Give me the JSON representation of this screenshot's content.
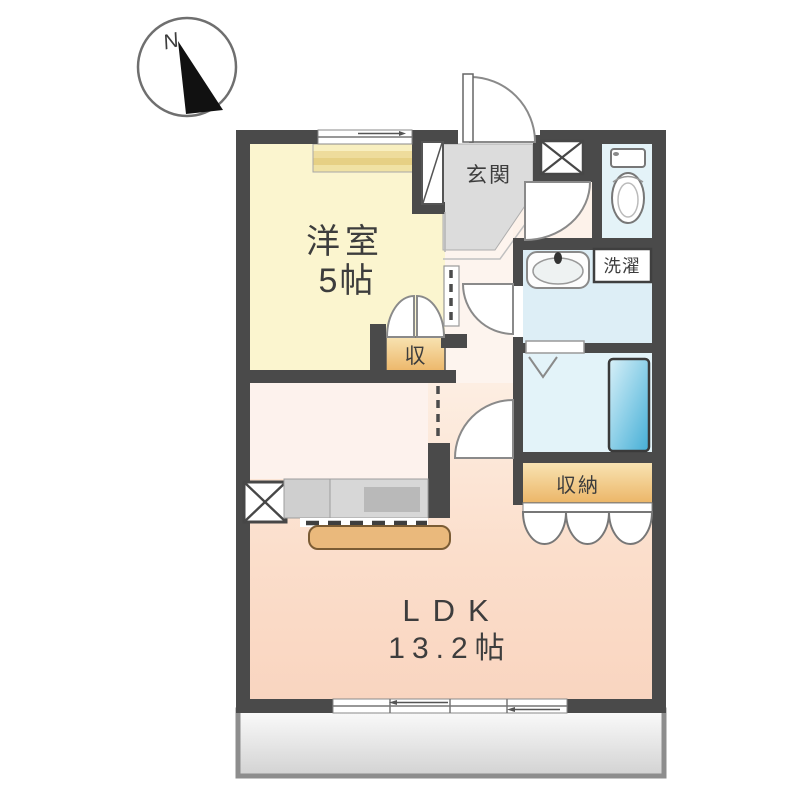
{
  "compass": {
    "north_label": "N"
  },
  "rooms": {
    "western_room": {
      "name": "洋室",
      "size": "5帖"
    },
    "ldk": {
      "name": "LDK",
      "size": "13.2帖"
    },
    "entrance": {
      "name": "玄関"
    },
    "laundry": {
      "label": "洗濯"
    },
    "closet": {
      "label": "収"
    },
    "storage": {
      "label": "収納"
    }
  },
  "colors": {
    "wall": "#4a4a4a",
    "western_room": "#fbf5cf",
    "ldk": "#fbdcc8",
    "hall": "#fdf4ee",
    "kitchen_nook": "#fdf2ed",
    "entrance": "#dcdcdc",
    "toilet_room": "#e4f3f8",
    "washroom": "#ddeef6",
    "bathroom": "#e3f3f9",
    "storage": "#f0c683",
    "bathtub": "#55b5da",
    "kitchen_counter": "#d7d7d7",
    "counter_top": "#eab97c",
    "balcony": "#d9d9d9"
  }
}
